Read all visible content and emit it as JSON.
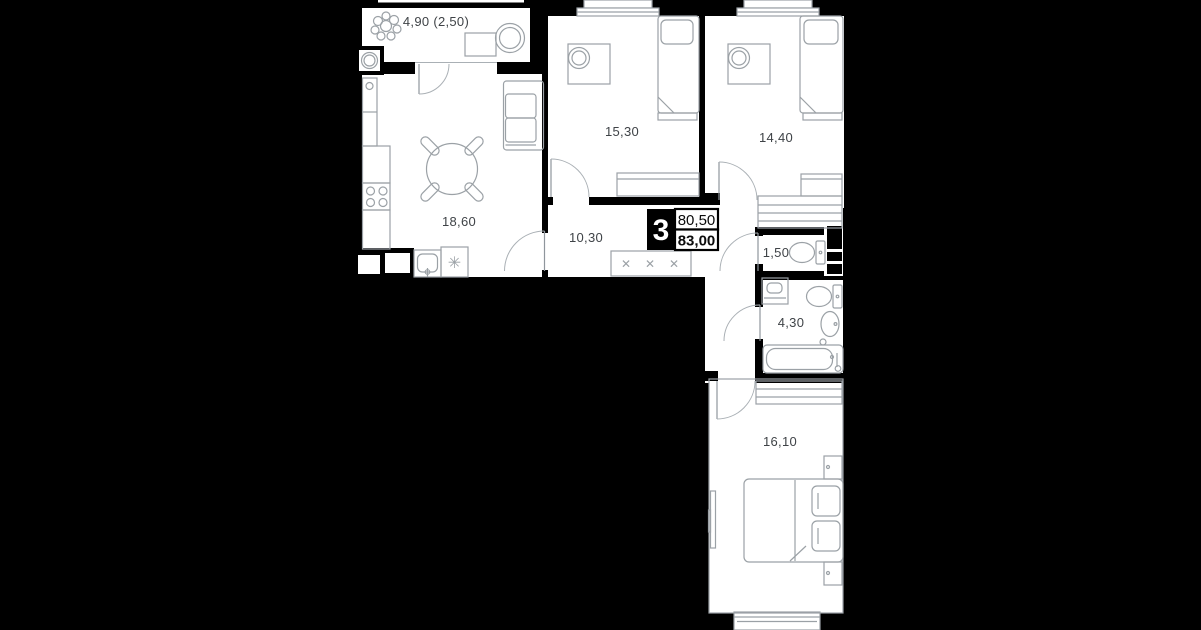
{
  "plan": {
    "title": "apartment-floor-plan",
    "badge": {
      "rooms_count": "3",
      "area_living": "80,50",
      "area_total": "83,00"
    },
    "rooms": [
      {
        "name": "balcony",
        "area": "4,90 (2,50)"
      },
      {
        "name": "kitchen-living",
        "area": "18,60"
      },
      {
        "name": "bedroom-top-left",
        "area": "15,30"
      },
      {
        "name": "bedroom-top-right",
        "area": "14,40"
      },
      {
        "name": "hallway",
        "area": "10,30"
      },
      {
        "name": "wc",
        "area": "1,50"
      },
      {
        "name": "bathroom",
        "area": "4,30"
      },
      {
        "name": "bedroom-bottom",
        "area": "16,10"
      }
    ],
    "icons": {
      "dishwasher": "✳",
      "shoe_mark": "✕"
    },
    "colors": {
      "background": "#000000",
      "floor": "#ffffff",
      "walls": "#000000",
      "furniture_line": "#9ba1a6",
      "label_text": "#3f4347"
    }
  }
}
